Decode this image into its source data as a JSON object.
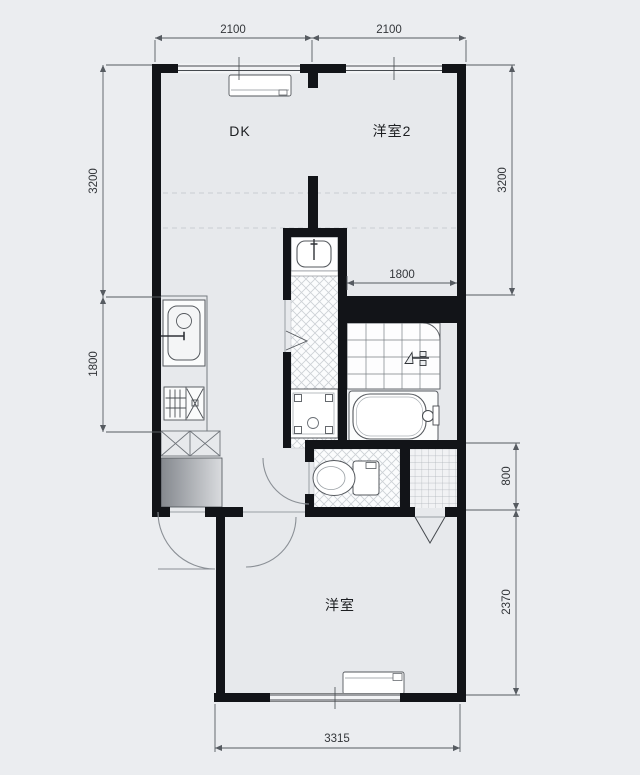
{
  "plan": {
    "rooms": [
      {
        "id": "dk",
        "label": "DK"
      },
      {
        "id": "western-room-2",
        "label": "洋室2"
      },
      {
        "id": "western-room",
        "label": "洋室"
      }
    ],
    "dimensions_mm": {
      "top": [
        "2100",
        "2100"
      ],
      "left": [
        "3200",
        "1800"
      ],
      "right": [
        "3200",
        "800",
        "2370"
      ],
      "bottom": [
        "3315"
      ],
      "inner": [
        "1800"
      ]
    },
    "fixtures": [
      "air-conditioner",
      "kitchen-sink",
      "gas-stove",
      "appliance-space",
      "shoe-cabinet",
      "washbasin",
      "washing-machine-pan",
      "bathtub",
      "shower-mixer",
      "toilet",
      "entrance-door",
      "interior-door",
      "window"
    ],
    "colors": {
      "background": "#ebedf0",
      "floor": "#e7e9ec",
      "wall": "#121418",
      "dimension_line": "#565b61",
      "tile_line": "#7a8085",
      "hatch_line": "#ccd0d5"
    }
  }
}
